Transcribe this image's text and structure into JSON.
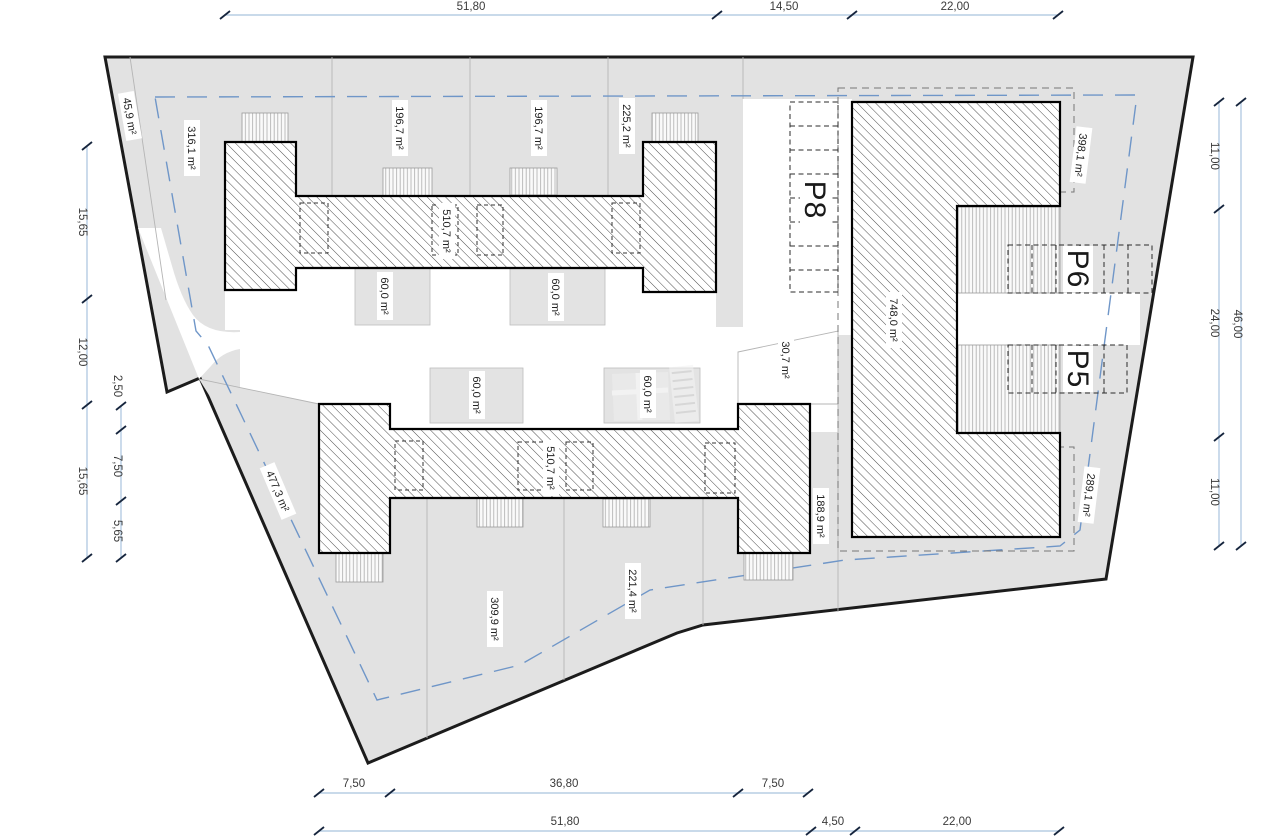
{
  "drawing": {
    "type": "site-plan",
    "colors": {
      "site_fill": "#e2e2e2",
      "boundary": "#1c1c1c",
      "dim_line": "#a9c3de",
      "dim_tick": "#16253d",
      "dim_text": "#3a3a3a",
      "setback_dashed": "#6f96c8",
      "lot_line": "#b5b5b5",
      "building_hatch": "#3a3a3a"
    }
  },
  "dims": {
    "top": [
      "51,80",
      "14,50",
      "22,00"
    ],
    "bottom_upper": [
      "7,50",
      "36,80",
      "7,50"
    ],
    "bottom_lower": [
      "51,80",
      "4,50",
      "22,00"
    ],
    "left_outer": [
      "15,65",
      "12,00",
      "15,65"
    ],
    "left_inner": [
      "2,50",
      "7,50",
      "5,65"
    ],
    "right_inner": [
      "11,00",
      "24,00",
      "11,00"
    ],
    "right_outer": [
      "46,00"
    ]
  },
  "areas": {
    "wedge_nw": "45,9 m²",
    "lot_nw": "316,1 m²",
    "lot_n1": "196,7 m²",
    "lot_n2": "196,7 m²",
    "lot_n3": "225,2 m²",
    "upper_building": "510,7 m²",
    "garden_un1": "60,0 m²",
    "garden_un2": "60,0 m²",
    "garden_ls1": "60,0 m²",
    "garden_ls2": "60,0 m²",
    "lot_ne": "398,1 m²",
    "east_building": "748,0 m²",
    "wedge_center": "30,7 m²",
    "lot_se": "289,1 m²",
    "lot_strip": "188,9 m²",
    "lower_building": "510,7 m²",
    "lot_sw": "477,3 m²",
    "lot_s1": "309,9 m²",
    "lot_s2": "221,4 m²"
  },
  "parking": {
    "p8": "P8",
    "p6": "P6",
    "p5": "P5"
  }
}
